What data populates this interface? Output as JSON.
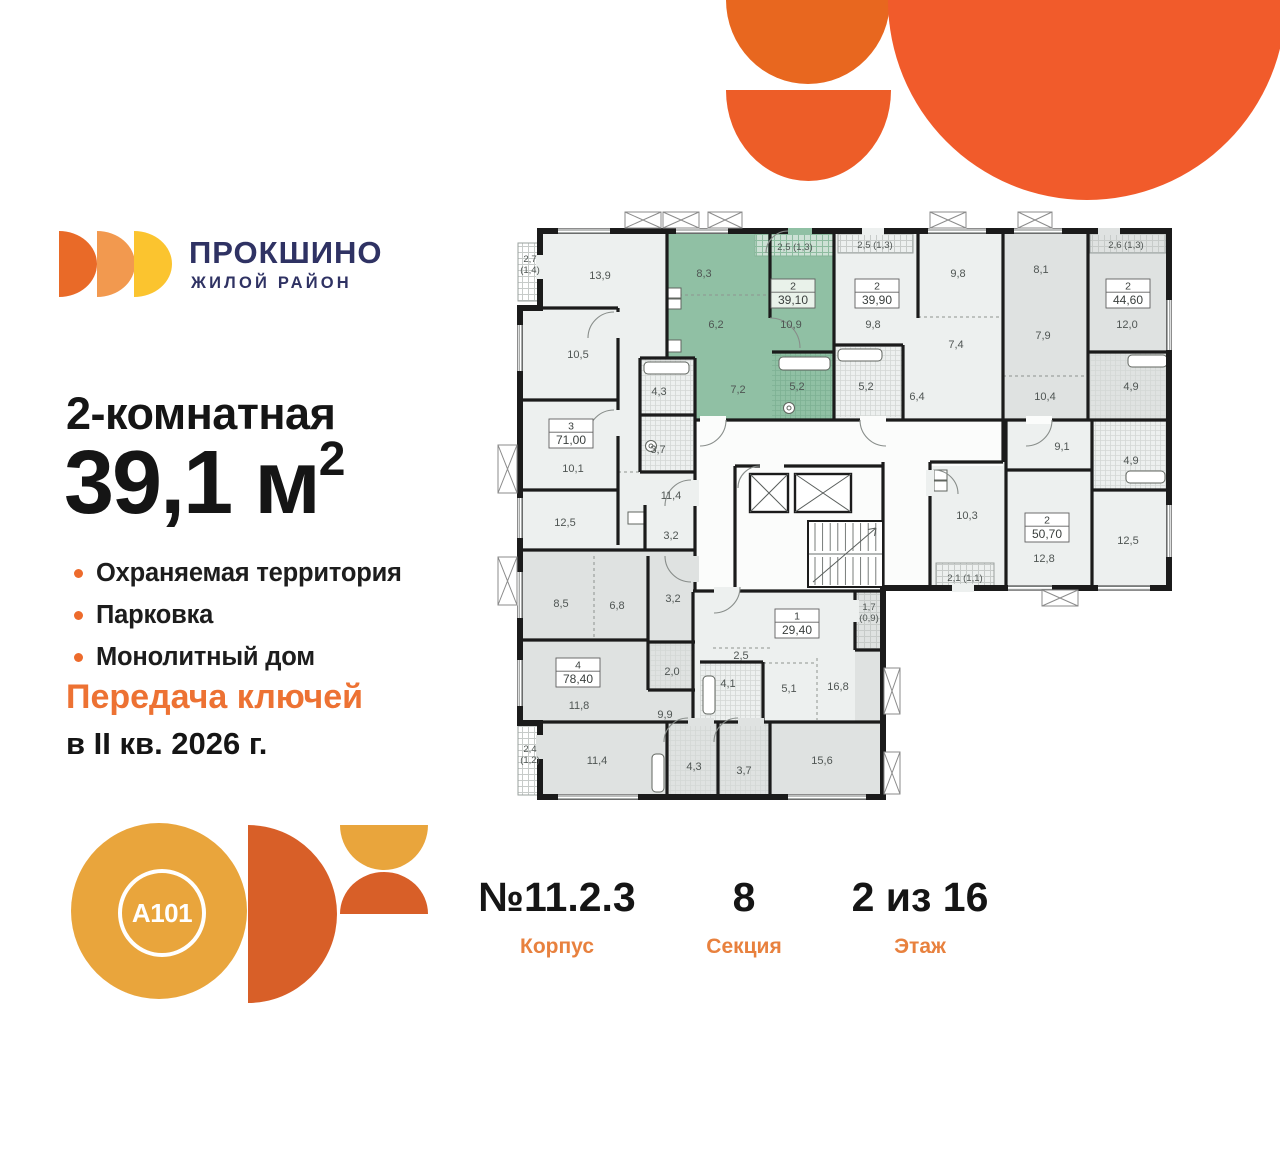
{
  "brand": {
    "name": "ПРОКШИНО",
    "tagline": "ЖИЛОЙ РАЙОН",
    "logo_colors": [
      "#E96A28",
      "#F2994F",
      "#FBC42F"
    ],
    "navy": "#2F3263"
  },
  "listing": {
    "rooms_title": "2-комнатная",
    "area_value": "39,1",
    "area_unit": "м",
    "area_sup": "2"
  },
  "features": [
    "Охраняемая территория",
    "Парковка",
    "Монолитный дом"
  ],
  "handover": {
    "line1": "Передача ключей",
    "line2": "в II кв. 2026 г."
  },
  "footer": {
    "corpus": {
      "value": "№11.2.3",
      "label": "Корпус"
    },
    "section": {
      "value": "8",
      "label": "Секция"
    },
    "floor": {
      "value": "2 из 16",
      "label": "Этаж"
    }
  },
  "developer_logo": {
    "text": "A101",
    "amber": "#E9A53C",
    "orange": "#D85F28"
  },
  "accent_orange": "#ED6B2C",
  "plan": {
    "highlight_color": "#90c0a4",
    "highlight_box_bg": "#e9f2ea",
    "apartment_boxes": [
      {
        "rooms": "3",
        "area": "71,00",
        "x": 549,
        "y": 419
      },
      {
        "rooms": "4",
        "area": "78,40",
        "x": 556,
        "y": 658
      },
      {
        "rooms": "1",
        "area": "29,40",
        "x": 775,
        "y": 609
      },
      {
        "rooms": "2",
        "area": "39,10",
        "x": 771,
        "y": 279,
        "highlight": true
      },
      {
        "rooms": "2",
        "area": "39,90",
        "x": 855,
        "y": 279
      },
      {
        "rooms": "2",
        "area": "44,60",
        "x": 1106,
        "y": 279
      },
      {
        "rooms": "2",
        "area": "50,70",
        "x": 1025,
        "y": 513
      }
    ],
    "room_labels": [
      {
        "t": "13,9",
        "x": 600,
        "y": 279
      },
      {
        "t": "10,5",
        "x": 578,
        "y": 358
      },
      {
        "t": "10,1",
        "x": 573,
        "y": 472
      },
      {
        "t": "12,5",
        "x": 565,
        "y": 526
      },
      {
        "t": "11,4",
        "x": 671,
        "y": 499
      },
      {
        "t": "4,3",
        "x": 659,
        "y": 395
      },
      {
        "t": "3,7",
        "x": 658,
        "y": 453
      },
      {
        "t": "3,2",
        "x": 671,
        "y": 539
      },
      {
        "lines": [
          "2,7",
          "(1,4)"
        ],
        "x": 530,
        "y": 262
      },
      {
        "t": "8,3",
        "x": 704,
        "y": 277
      },
      {
        "t": "6,2",
        "x": 716,
        "y": 328
      },
      {
        "t": "10,9",
        "x": 791,
        "y": 328
      },
      {
        "t": "7,2",
        "x": 738,
        "y": 393
      },
      {
        "t": "5,2",
        "x": 797,
        "y": 390
      },
      {
        "t": "2,5 (1,3)",
        "x": 795,
        "y": 250,
        "s": 1
      },
      {
        "t": "9,8",
        "x": 873,
        "y": 328
      },
      {
        "t": "9,8",
        "x": 958,
        "y": 277
      },
      {
        "t": "7,4",
        "x": 956,
        "y": 348
      },
      {
        "t": "6,4",
        "x": 917,
        "y": 400
      },
      {
        "t": "5,2",
        "x": 866,
        "y": 390
      },
      {
        "t": "2,5 (1,3)",
        "x": 875,
        "y": 248,
        "s": 1
      },
      {
        "t": "8,1",
        "x": 1041,
        "y": 273
      },
      {
        "t": "7,9",
        "x": 1043,
        "y": 339
      },
      {
        "t": "12,0",
        "x": 1127,
        "y": 328
      },
      {
        "t": "10,4",
        "x": 1045,
        "y": 400
      },
      {
        "t": "4,9",
        "x": 1131,
        "y": 390
      },
      {
        "t": "2,6 (1,3)",
        "x": 1126,
        "y": 248,
        "s": 1
      },
      {
        "t": "9,1",
        "x": 1062,
        "y": 450
      },
      {
        "t": "4,9",
        "x": 1131,
        "y": 464
      },
      {
        "t": "10,3",
        "x": 967,
        "y": 519
      },
      {
        "t": "12,8",
        "x": 1044,
        "y": 562
      },
      {
        "t": "12,5",
        "x": 1128,
        "y": 544
      },
      {
        "t": "2,1 (1,1)",
        "x": 965,
        "y": 581,
        "s": 1
      },
      {
        "t": "8,5",
        "x": 561,
        "y": 607
      },
      {
        "t": "6,8",
        "x": 617,
        "y": 609
      },
      {
        "t": "3,2",
        "x": 673,
        "y": 602
      },
      {
        "t": "11,8",
        "x": 579,
        "y": 709
      },
      {
        "t": "2,0",
        "x": 672,
        "y": 675
      },
      {
        "t": "9,9",
        "x": 665,
        "y": 718
      },
      {
        "lines": [
          "2,4",
          "(1,2)"
        ],
        "x": 530,
        "y": 752
      },
      {
        "t": "11,4",
        "x": 597,
        "y": 764
      },
      {
        "t": "4,3",
        "x": 694,
        "y": 770
      },
      {
        "t": "3,7",
        "x": 744,
        "y": 774
      },
      {
        "t": "15,6",
        "x": 822,
        "y": 764
      },
      {
        "t": "2,5",
        "x": 741,
        "y": 659
      },
      {
        "t": "4,1",
        "x": 728,
        "y": 687
      },
      {
        "t": "5,1",
        "x": 789,
        "y": 692
      },
      {
        "t": "16,8",
        "x": 838,
        "y": 690
      },
      {
        "lines": [
          "1,7",
          "(0,9)"
        ],
        "x": 869,
        "y": 610
      }
    ]
  }
}
